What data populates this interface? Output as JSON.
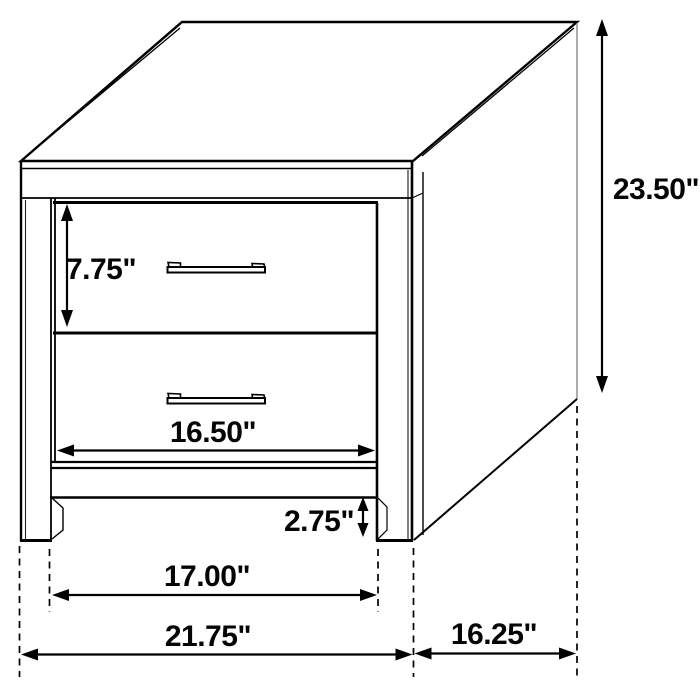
{
  "diagram": {
    "background_color": "#ffffff",
    "line_color": "#000000",
    "unit": "inches",
    "dimensions": {
      "drawer_height": "7.75\"",
      "overall_height": "23.50\"",
      "drawer_width": "16.50\"",
      "leg_height": "2.75\"",
      "leg_span_width": "17.00\"",
      "overall_width": "21.75\"",
      "side_depth": "16.25\""
    }
  }
}
